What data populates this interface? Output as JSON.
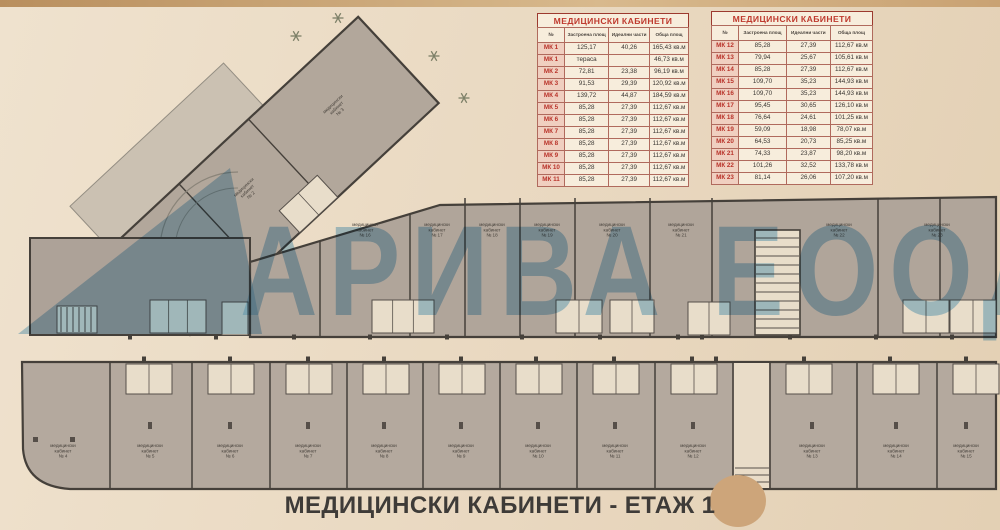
{
  "page": {
    "title": "МЕДИЦИНСКИ КАБИНЕТИ - ЕТАЖ 1"
  },
  "watermark": {
    "text": "АРИВА ЕООД",
    "color": "#61a8d6"
  },
  "tables": [
    {
      "title": "МЕДИЦИНСКИ КАБИНЕТИ",
      "columns": [
        "№",
        "Застроена площ",
        "Идеални части",
        "Обща площ"
      ],
      "rows": [
        [
          "МК 1",
          "125,17",
          "40,26",
          "165,43 кв.м"
        ],
        [
          "МК 1",
          "тераса",
          "",
          "46,73 кв.м"
        ],
        [
          "МК 2",
          "72,81",
          "23,38",
          "96,19 кв.м"
        ],
        [
          "МК 3",
          "91,53",
          "29,39",
          "120,92 кв.м"
        ],
        [
          "МК 4",
          "139,72",
          "44,87",
          "184,59 кв.м"
        ],
        [
          "МК 5",
          "85,28",
          "27,39",
          "112,67 кв.м"
        ],
        [
          "МК 6",
          "85,28",
          "27,39",
          "112,67 кв.м"
        ],
        [
          "МК 7",
          "85,28",
          "27,39",
          "112,67 кв.м"
        ],
        [
          "МК 8",
          "85,28",
          "27,39",
          "112,67 кв.м"
        ],
        [
          "МК 9",
          "85,28",
          "27,39",
          "112,67 кв.м"
        ],
        [
          "МК 10",
          "85,28",
          "27,39",
          "112,67 кв.м"
        ],
        [
          "МК 11",
          "85,28",
          "27,39",
          "112,67 кв.м"
        ]
      ]
    },
    {
      "title": "МЕДИЦИНСКИ КАБИНЕТИ",
      "columns": [
        "№",
        "Застроена площ",
        "Идеални части",
        "Обща площ"
      ],
      "rows": [
        [
          "МК 12",
          "85,28",
          "27,39",
          "112,67 кв.м"
        ],
        [
          "МК 13",
          "79,94",
          "25,67",
          "105,61 кв.м"
        ],
        [
          "МК 14",
          "85,28",
          "27,39",
          "112,67 кв.м"
        ],
        [
          "МК 15",
          "109,70",
          "35,23",
          "144,93 кв.м"
        ],
        [
          "МК 16",
          "109,70",
          "35,23",
          "144,93 кв.м"
        ],
        [
          "МК 17",
          "95,45",
          "30,65",
          "126,10 кв.м"
        ],
        [
          "МК 18",
          "76,64",
          "24,61",
          "101,25 кв.м"
        ],
        [
          "МК 19",
          "59,09",
          "18,98",
          "78,07 кв.м"
        ],
        [
          "МК 20",
          "64,53",
          "20,73",
          "85,25 кв.м"
        ],
        [
          "МК 21",
          "74,33",
          "23,87",
          "98,20 кв.м"
        ],
        [
          "МК 22",
          "101,26",
          "32,52",
          "133,78 кв.м"
        ],
        [
          "МК 23",
          "81,14",
          "26,06",
          "107,20 кв.м"
        ]
      ]
    }
  ],
  "plan": {
    "label_word1": "медицински",
    "label_word2": "кабинет",
    "wing_rooms": [
      "№ 1",
      "№ 2",
      "№ 3"
    ],
    "bottom_rooms": [
      "№ 4",
      "№ 5",
      "№ 6",
      "№ 7",
      "№ 8",
      "№ 9",
      "№ 10",
      "№ 11",
      "№ 12",
      "№ 13",
      "№ 14",
      "№ 15"
    ],
    "top_rooms": [
      "№ 16",
      "№ 17",
      "№ 18",
      "№ 19",
      "№ 20",
      "№ 21",
      "№ 22",
      "№ 23"
    ]
  }
}
